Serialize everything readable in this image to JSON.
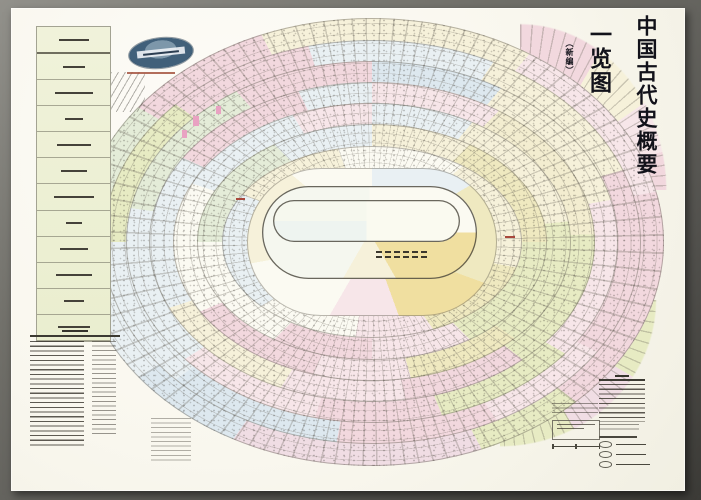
{
  "poster": {
    "title": {
      "main": "中国古代史概要",
      "sub": "一览图",
      "note": "（新编）"
    },
    "emblem": {
      "icon": "publisher-globe-emblem"
    },
    "diagram": {
      "type": "concentric-oval-dynasty-timeline",
      "rings_count": 10,
      "texture": [
        "radial-tick-lines",
        "fine-ring-lines",
        "micro-text-specks"
      ]
    },
    "palette": {
      "frame_gray": "#706f69",
      "paper": "#f9f7ee",
      "pink": "#f2d8de",
      "pink_light": "#f7e6e9",
      "pink_bottom": "#f0dde4",
      "cream": "#f6f1da",
      "yellow": "#efe9c0",
      "yellow_green": "#e7ebc3",
      "blue": "#dde8ef",
      "blue_light": "#e9f0f3",
      "green": "#e4ecd8",
      "highlight_orange": "#f0dfa0",
      "ink": "#3a382f",
      "red_accent": "#a8483c",
      "magenta_accent": "#e9a2c2",
      "logo_blue": "#41607a"
    }
  }
}
